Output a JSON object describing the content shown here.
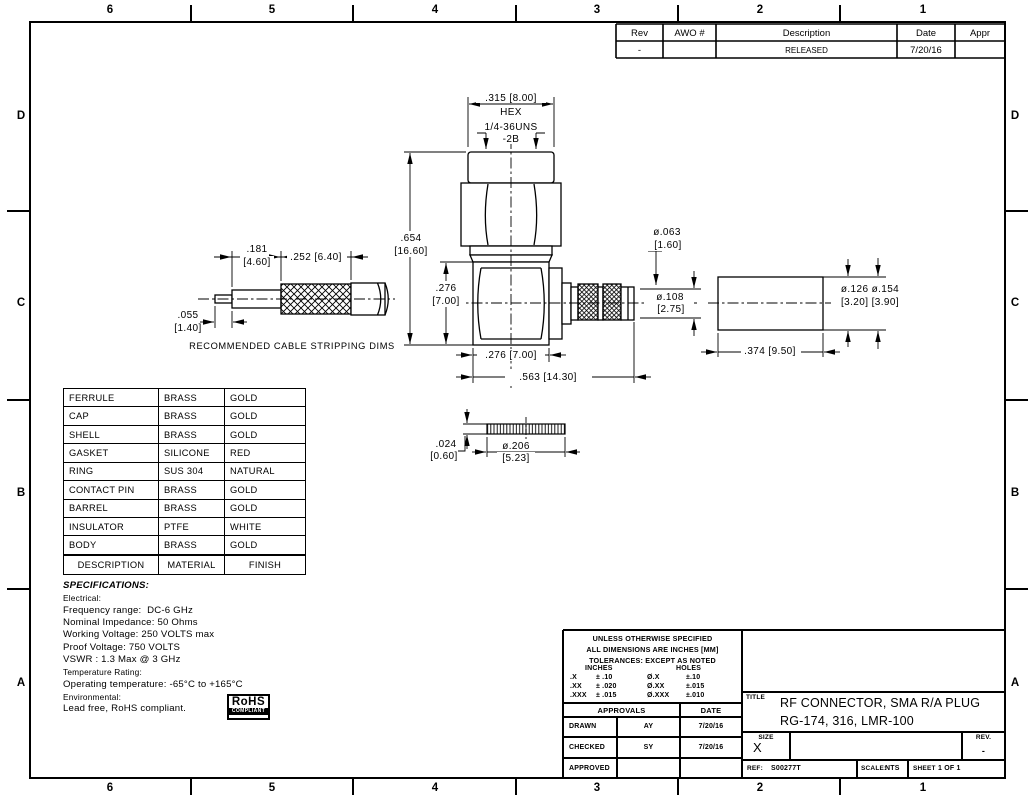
{
  "sheet": {
    "zones_cols": [
      "6",
      "5",
      "4",
      "3",
      "2",
      "1"
    ],
    "zones_rows": [
      "D",
      "C",
      "B",
      "A"
    ]
  },
  "rev_table": {
    "headers": [
      "Rev",
      "AWO #",
      "Description",
      "Date",
      "Appr"
    ],
    "row": {
      "rev": "-",
      "awo": "",
      "description": "RELEASED",
      "date": "7/20/16",
      "appr": ""
    }
  },
  "dims": {
    "hex_width": ".315 [8.00]",
    "hex": "HEX",
    "thread1": "1/4-36UNS",
    "thread2": "-2B",
    "height_in": ".654",
    "height_mm": "[16.60]",
    "body_h_in": ".276",
    "body_h_mm": "[7.00]",
    "body_w": ".276 [7.00]",
    "total_w": ".563 [14.30]",
    "pin_dia": "ø.063",
    "pin_dia_mm": "[1.60]",
    "barrel_dia": "ø.108",
    "barrel_dia_mm": "[2.75]"
  },
  "strip": {
    "dim1_in": ".181",
    "dim1_mm": "[4.60]",
    "dim2": ".252 [6.40]",
    "dim3_in": ".055",
    "dim3_mm": "[1.40]",
    "caption": "RECOMMENDED CABLE STRIPPING DIMS"
  },
  "ferrule": {
    "dia": "ø.126 ø.154",
    "dia_mm": "[3.20] [3.90]",
    "length": ".374 [9.50]"
  },
  "gasket": {
    "thk_in": ".024",
    "thk_mm": "[0.60]",
    "dia_in": "ø.206",
    "dia_mm": "[5.23]"
  },
  "materials": {
    "rows": [
      [
        "FERRULE",
        "BRASS",
        "GOLD"
      ],
      [
        "CAP",
        "BRASS",
        "GOLD"
      ],
      [
        "SHELL",
        "BRASS",
        "GOLD"
      ],
      [
        "GASKET",
        "SILICONE",
        "RED"
      ],
      [
        "RING",
        "SUS 304",
        "NATURAL"
      ],
      [
        "CONTACT PIN",
        "BRASS",
        "GOLD"
      ],
      [
        "BARREL",
        "BRASS",
        "GOLD"
      ],
      [
        "INSULATOR",
        "PTFE",
        "WHITE"
      ],
      [
        "BODY",
        "BRASS",
        "GOLD"
      ]
    ],
    "footer": [
      "DESCRIPTION",
      "MATERIAL",
      "FINISH"
    ]
  },
  "specs": {
    "title": "SPECIFICATIONS:",
    "lines": [
      "Electrical:",
      "Frequency range:  DC-6 GHz",
      "Nominal Impedance: 50 Ohms",
      "Working Voltage: 250 VOLTS max",
      "Proof Voltage: 750 VOLTS",
      "VSWR : 1.3 Max @ 3 GHz",
      "Temperature Rating:",
      "Operating temperature: -65°C to +165°C",
      "Environmental:",
      "Lead free, RoHS compliant."
    ]
  },
  "rohs": {
    "name": "RoHS",
    "compliant": "COMPLIANT"
  },
  "tolerances": {
    "line1": "UNLESS OTHERWISE SPECIFIED",
    "line2": "ALL DIMENSIONS ARE INCHES [MM]",
    "line3": "TOLERANCES: EXCEPT AS NOTED",
    "inches": "INCHES",
    "holes": "HOLES",
    "rows": [
      [
        ".X",
        "± .10",
        "Ø.X",
        "±.10"
      ],
      [
        ".XX",
        "± .020",
        "Ø.XX",
        "±.015"
      ],
      [
        ".XXX",
        "± .015",
        "Ø.XXX",
        "±.010"
      ]
    ]
  },
  "approvals": {
    "header": "APPROVALS",
    "date_header": "DATE",
    "rows": [
      {
        "label": "DRAWN",
        "by": "AY",
        "date": "7/20/16"
      },
      {
        "label": "CHECKED",
        "by": "SY",
        "date": "7/20/16"
      },
      {
        "label": "APPROVED",
        "by": "",
        "date": ""
      }
    ]
  },
  "title_block": {
    "title_label": "TITLE",
    "title1": "RF CONNECTOR, SMA R/A PLUG",
    "title2": "RG-174, 316, LMR-100",
    "size_label": "SIZE",
    "size": "X",
    "rev_label": "REV.",
    "rev": "-",
    "ref_label": "REF:",
    "ref": "S00277T",
    "scale_label": "SCALE:",
    "scale": "NTS",
    "sheet_label": "SHEET",
    "sheet": "1 OF 1"
  }
}
